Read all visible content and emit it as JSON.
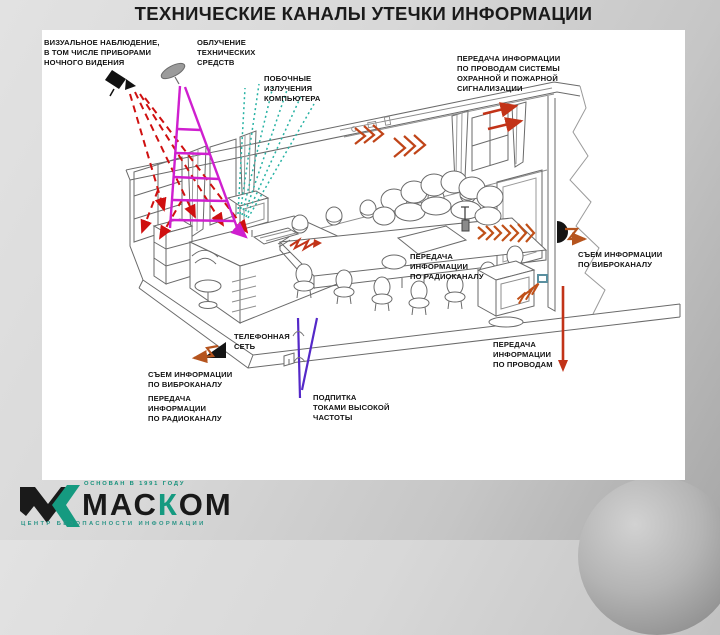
{
  "slide": {
    "title": "ТЕХНИЧЕСКИЕ КАНАЛЫ УТЕЧКИ ИНФОРМАЦИИ"
  },
  "labels": {
    "visual_observation": "ВИЗУАЛЬНОЕ НАБЛЮДЕНИЕ,\nВ ТОМ ЧИСЛЕ ПРИБОРАМИ\nНОЧНОГО ВИДЕНИЯ",
    "irradiation": "ОБЛУЧЕНИЕ\nТЕХНИЧЕСКИХ\nСРЕДСТВ",
    "side_emissions": "ПОБОЧНЫЕ\nИЗЛУЧЕНИЯ\nКОМПЬЮТЕРА",
    "alarm_wires": "ПЕРЕДАЧА ИНФОРМАЦИИ\nПО ПРОВОДАМ СИСТЕМЫ\nОХРАННОЙ И ПОЖАРНОЙ\nСИГНАЛИЗАЦИИ",
    "radio_channel_sofa": "ПЕРЕДАЧА\nИНФОРМАЦИИ\nПО РАДИОКАНАЛУ",
    "vibro_channel_right": "СЪЕМ ИНФОРМАЦИИ\nПО ВИБРОКАНАЛУ",
    "phone_network": "ТЕЛЕФОННАЯ\nСЕТЬ",
    "vibro_channel_left": "СЪЕМ ИНФОРМАЦИИ\nПО ВИБРОКАНАЛУ",
    "radio_channel_left": "ПЕРЕДАЧА\nИНФОРМАЦИИ\nПО РАДИОКАНАЛУ",
    "hf_feed": "ПОДПИТКА\nТОКАМИ ВЫСОКОЙ\nЧАСТОТЫ",
    "wires_bottom": "ПЕРЕДАЧА\nИНФОРМАЦИИ\nПО ПРОВОДАМ"
  },
  "logo": {
    "brand_pre": "МАС",
    "brand_accent": "К",
    "brand_post": "ОМ",
    "tagline_top": "ОСНОВАН В 1991 ГОДУ",
    "tagline_bottom": "ЦЕНТР БЕЗОПАСНОСТИ ИНФОРМАЦИИ"
  },
  "colors": {
    "accent_red": "#cf1010",
    "accent_red_orange": "#c23318",
    "accent_orange": "#c05018",
    "accent_magenta": "#cf1fcf",
    "accent_teal": "#27b2a4",
    "accent_purple": "#5428c8",
    "brand_green": "#159a80",
    "panel_bg": "#ffffff",
    "page_bg": "#d8d8d8"
  },
  "icons": {
    "camera-icon": "night-vision surveillance camera",
    "dish-antenna-icon": "irradiation antenna dish",
    "radio-bug-icon": "radio transmitter bug with antenna",
    "contact-mic-icon": "contact microphone on wall",
    "wedge-mic-icon": "vibro pickup on floor slab",
    "chevron-waves": "radio emission waves",
    "logo-mark": "MASKOM V+K chevron mark"
  }
}
